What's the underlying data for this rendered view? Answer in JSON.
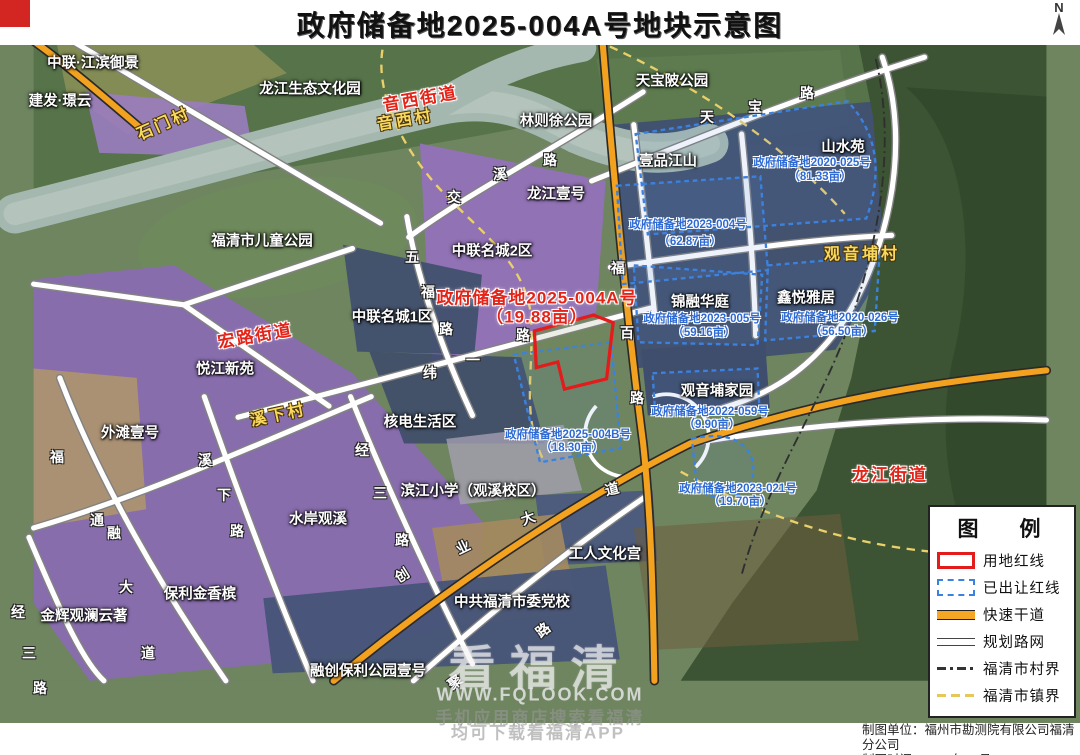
{
  "title": {
    "text": "政府储备地2025-004A号地块示意图"
  },
  "north_label": "N",
  "credits": {
    "line1": "制图单位：福州市勘测院有限公司福清分公司",
    "line2": "制图时间：2025年08月"
  },
  "watermark": {
    "big": "看福清",
    "url": "WWW.FQLOOK.COM",
    "tip1": "手机应用商店搜索看福清",
    "tip2": "均可下载看福清APP"
  },
  "legend": {
    "title": "图　例",
    "items": [
      {
        "label": "用地红线",
        "swatch": "red-outline"
      },
      {
        "label": "已出让红线",
        "swatch": "blue-dashed"
      },
      {
        "label": "快速干道",
        "swatch": "orange-line"
      },
      {
        "label": "规划路网",
        "swatch": "double-line"
      },
      {
        "label": "福清市村界",
        "swatch": "dashdot-line"
      },
      {
        "label": "福清市镇界",
        "swatch": "yellow-dashed"
      }
    ]
  },
  "colors": {
    "redline": "#e31b1b",
    "sold_parcel_blue": "#3b82e0",
    "expressway_orange": "#f5a723",
    "village_label_yellow": "#f8d95e",
    "street_label_red": "#e42418"
  },
  "map": {
    "labels": [
      {
        "t": "中联·江滨御景",
        "x": 93,
        "y": 62,
        "c": "place"
      },
      {
        "t": "建发·璟云",
        "x": 60,
        "y": 100,
        "c": "place"
      },
      {
        "t": "龙江生态文化园",
        "x": 310,
        "y": 88,
        "c": "place"
      },
      {
        "t": "林则徐公园",
        "x": 556,
        "y": 120,
        "c": "place"
      },
      {
        "t": "天宝陂公园",
        "x": 672,
        "y": 80,
        "c": "place"
      },
      {
        "t": "壹品江山",
        "x": 668,
        "y": 160,
        "c": "place"
      },
      {
        "t": "山水苑",
        "x": 843,
        "y": 146,
        "c": "place"
      },
      {
        "t": "福清市儿童公园",
        "x": 262,
        "y": 240,
        "c": "place"
      },
      {
        "t": "龙江壹号",
        "x": 556,
        "y": 193,
        "c": "place"
      },
      {
        "t": "中联名城2区",
        "x": 492,
        "y": 250,
        "c": "place"
      },
      {
        "t": "中联名城1区",
        "x": 392,
        "y": 316,
        "c": "place"
      },
      {
        "t": "悦江新苑",
        "x": 225,
        "y": 368,
        "c": "place"
      },
      {
        "t": "外滩壹号",
        "x": 130,
        "y": 432,
        "c": "place"
      },
      {
        "t": "核电生活区",
        "x": 420,
        "y": 421,
        "c": "place"
      },
      {
        "t": "观音埔家园",
        "x": 717,
        "y": 390,
        "c": "place"
      },
      {
        "t": "锦融华庭",
        "x": 700,
        "y": 301,
        "c": "place"
      },
      {
        "t": "鑫悦雅居",
        "x": 806,
        "y": 297,
        "c": "place"
      },
      {
        "t": "滨江小学（观溪校区）",
        "x": 473,
        "y": 490,
        "c": "place"
      },
      {
        "t": "水岸观溪",
        "x": 318,
        "y": 518,
        "c": "place"
      },
      {
        "t": "保利金香槟",
        "x": 200,
        "y": 593,
        "c": "place"
      },
      {
        "t": "金辉观澜云著",
        "x": 84,
        "y": 615,
        "c": "place"
      },
      {
        "t": "融创保利公园壹号",
        "x": 368,
        "y": 670,
        "c": "place"
      },
      {
        "t": "工人文化宫",
        "x": 605,
        "y": 553,
        "c": "place"
      },
      {
        "t": "中共福清市委党校",
        "x": 512,
        "y": 601,
        "c": "place"
      },
      {
        "t": "石门村",
        "x": 163,
        "y": 122,
        "c": "village",
        "r": -24
      },
      {
        "t": "音西村",
        "x": 405,
        "y": 118,
        "c": "village",
        "r": -10
      },
      {
        "t": "观音埔村",
        "x": 862,
        "y": 252,
        "c": "village",
        "r": 0
      },
      {
        "t": "溪下村",
        "x": 278,
        "y": 413,
        "c": "village",
        "r": -12
      },
      {
        "t": "音西街道",
        "x": 420,
        "y": 97,
        "c": "street",
        "r": -10
      },
      {
        "t": "宏路街道",
        "x": 255,
        "y": 334,
        "c": "street",
        "r": -10
      },
      {
        "t": "龙江街道",
        "x": 890,
        "y": 473,
        "c": "street",
        "r": 0
      },
      {
        "t": "政府储备地2025-004A号",
        "x": 537,
        "y": 296,
        "c": "pr"
      },
      {
        "t": "（19.88亩）",
        "x": 537,
        "y": 315,
        "c": "pr"
      },
      {
        "t": "政府储备地2020-025号",
        "x": 812,
        "y": 162,
        "c": "pb"
      },
      {
        "t": "（81.33亩）",
        "x": 820,
        "y": 176,
        "c": "pb"
      },
      {
        "t": "政府储备地2023-004号",
        "x": 688,
        "y": 224,
        "c": "pb"
      },
      {
        "t": "（62.87亩）",
        "x": 690,
        "y": 241,
        "c": "pb"
      },
      {
        "t": "政府储备地2023-005号",
        "x": 702,
        "y": 318,
        "c": "pb"
      },
      {
        "t": "（59.16亩）",
        "x": 704,
        "y": 332,
        "c": "pb"
      },
      {
        "t": "政府储备地2020-026号",
        "x": 840,
        "y": 317,
        "c": "pb"
      },
      {
        "t": "（56.50亩）",
        "x": 842,
        "y": 331,
        "c": "pb"
      },
      {
        "t": "政府储备地2025-004B号",
        "x": 568,
        "y": 434,
        "c": "pb"
      },
      {
        "t": "（18.30亩）",
        "x": 572,
        "y": 447,
        "c": "pb"
      },
      {
        "t": "政府储备地2022-059号",
        "x": 710,
        "y": 411,
        "c": "pb"
      },
      {
        "t": "（9.90亩）",
        "x": 712,
        "y": 424,
        "c": "pb"
      },
      {
        "t": "政府储备地2023-021号",
        "x": 738,
        "y": 488,
        "c": "pb"
      },
      {
        "t": "（19.70亩）",
        "x": 740,
        "y": 501,
        "c": "pb"
      },
      {
        "t": "天",
        "x": 707,
        "y": 117,
        "c": "road"
      },
      {
        "t": "宝",
        "x": 755,
        "y": 107,
        "c": "road"
      },
      {
        "t": "路",
        "x": 807,
        "y": 93,
        "c": "road"
      },
      {
        "t": "交",
        "x": 454,
        "y": 197,
        "c": "road"
      },
      {
        "t": "溪",
        "x": 500,
        "y": 174,
        "c": "road"
      },
      {
        "t": "路",
        "x": 550,
        "y": 160,
        "c": "road"
      },
      {
        "t": "五",
        "x": 412,
        "y": 257,
        "c": "road"
      },
      {
        "t": "福",
        "x": 428,
        "y": 292,
        "c": "road"
      },
      {
        "t": "路",
        "x": 446,
        "y": 329,
        "c": "road"
      },
      {
        "t": "纬",
        "x": 430,
        "y": 373,
        "c": "road"
      },
      {
        "t": "一",
        "x": 473,
        "y": 360,
        "c": "road"
      },
      {
        "t": "路",
        "x": 523,
        "y": 335,
        "c": "road"
      },
      {
        "t": "福",
        "x": 618,
        "y": 268,
        "c": "road"
      },
      {
        "t": "百",
        "x": 627,
        "y": 333,
        "c": "road"
      },
      {
        "t": "路",
        "x": 637,
        "y": 398,
        "c": "road"
      },
      {
        "t": "溪",
        "x": 205,
        "y": 460,
        "c": "road"
      },
      {
        "t": "下",
        "x": 224,
        "y": 495,
        "c": "road"
      },
      {
        "t": "路",
        "x": 237,
        "y": 531,
        "c": "road"
      },
      {
        "t": "经",
        "x": 362,
        "y": 450,
        "c": "road"
      },
      {
        "t": "三",
        "x": 380,
        "y": 493,
        "c": "road"
      },
      {
        "t": "路",
        "x": 402,
        "y": 540,
        "c": "road"
      },
      {
        "t": "经",
        "x": 18,
        "y": 612,
        "c": "road"
      },
      {
        "t": "三",
        "x": 29,
        "y": 653,
        "c": "road"
      },
      {
        "t": "路",
        "x": 40,
        "y": 688,
        "c": "road"
      },
      {
        "t": "福",
        "x": 57,
        "y": 457,
        "c": "road"
      },
      {
        "t": "通",
        "x": 97,
        "y": 520,
        "c": "road"
      },
      {
        "t": "融",
        "x": 114,
        "y": 533,
        "c": "road"
      },
      {
        "t": "大",
        "x": 126,
        "y": 587,
        "c": "road"
      },
      {
        "t": "道",
        "x": 148,
        "y": 653,
        "c": "road"
      },
      {
        "t": "创",
        "x": 402,
        "y": 575,
        "c": "road",
        "r": -32
      },
      {
        "t": "业",
        "x": 463,
        "y": 547,
        "c": "road",
        "r": -26
      },
      {
        "t": "大",
        "x": 528,
        "y": 518,
        "c": "road",
        "r": -20
      },
      {
        "t": "道",
        "x": 612,
        "y": 489,
        "c": "road",
        "r": -14
      },
      {
        "t": "聚",
        "x": 455,
        "y": 682,
        "c": "road",
        "r": -38
      },
      {
        "t": "路",
        "x": 543,
        "y": 630,
        "c": "road",
        "r": -38
      }
    ]
  }
}
